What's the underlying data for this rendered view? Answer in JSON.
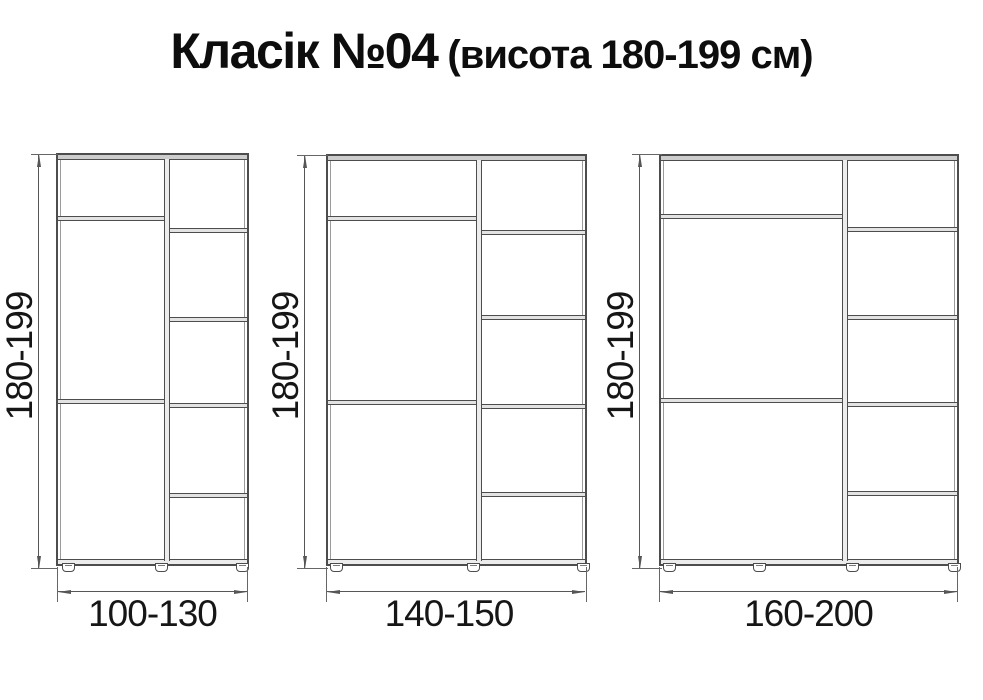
{
  "title": {
    "name": "Класік №04",
    "subtitle": "(висота 180-199 см)"
  },
  "cabinets": [
    {
      "width_label": "100-130",
      "height_label": "180-199"
    },
    {
      "width_label": "140-150",
      "height_label": "180-199"
    },
    {
      "width_label": "160-200",
      "height_label": "180-199"
    }
  ],
  "colors": {
    "line": "#4d4d4d",
    "dimension_line": "#565656",
    "text": "#161616"
  }
}
